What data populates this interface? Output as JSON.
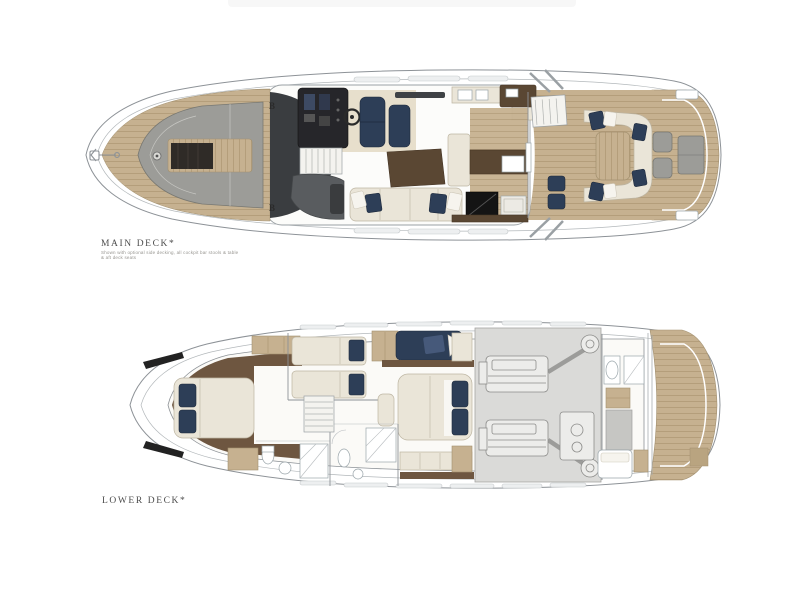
{
  "page": {
    "background": "#ffffff"
  },
  "main_deck": {
    "title": "MAIN DECK*",
    "note_line1": "Shown with optional side decking, all cockpit bar stools & table",
    "note_line2": "& aft deck seats",
    "cleat_marker_top": "B",
    "cleat_marker_bottom": "B"
  },
  "lower_deck": {
    "title": "LOWER DECK*"
  },
  "colors": {
    "teak": "#c6b190",
    "teak_line": "#b09a76",
    "navy": "#2d3e57",
    "cream": "#eae5d8",
    "cream_line": "#bdb5a2",
    "gray_pad": "#9c9c98",
    "walnut": "#6e5640",
    "wood_dark": "#5a4733",
    "hull_line": "#8d9297",
    "engine_room": "#dadad8",
    "dark_glass": "#3a3d40",
    "floor_white": "#fbfaf7"
  }
}
